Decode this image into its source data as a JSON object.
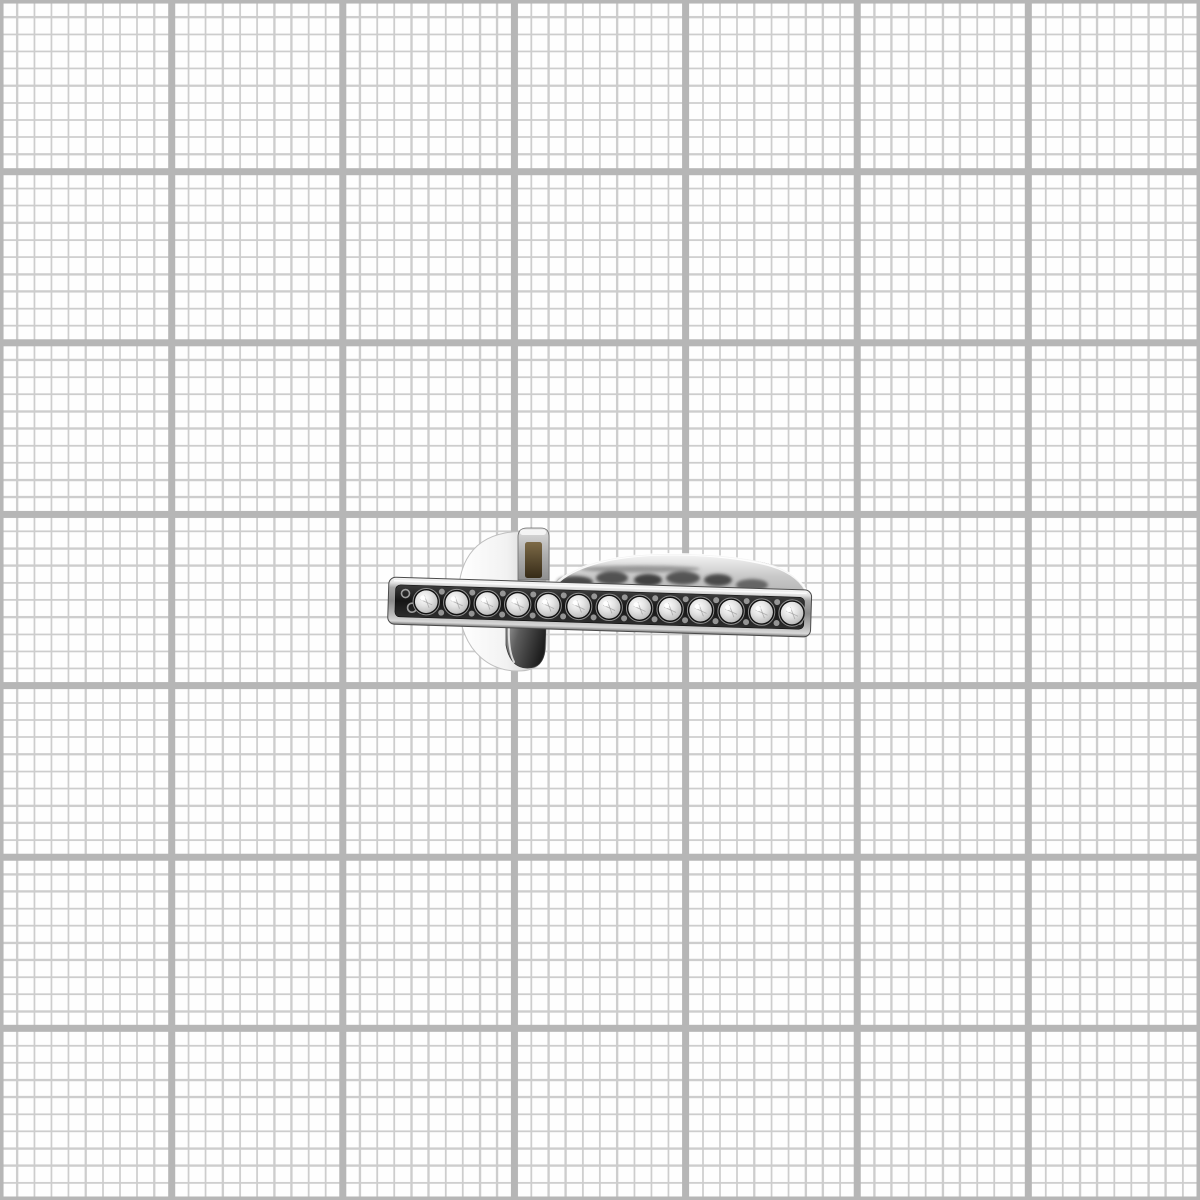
{
  "scene": {
    "subject": "antique silver-tone ring, side view, flat top bar channel-set with round clear crystals",
    "background": "white graph paper grid",
    "shadow": "none"
  },
  "grid": {
    "minor_step_px": 17.1429,
    "major_step_px": 171.4286,
    "minor_cells_per_major": 10,
    "major_columns": 7,
    "major_rows": 7,
    "minor_line_px": 2,
    "major_line_px": 7,
    "minor_color": "#cdcdcd",
    "major_color": "#b6b6b6",
    "paper_color": "#fefefe"
  },
  "ring": {
    "bar": {
      "left": 389,
      "top": 577,
      "width": 423,
      "height": 47,
      "tilt_deg": 1.78,
      "crystal_count": 13,
      "first_crystal_x": 427,
      "crystal_step_px": 30.5,
      "crystal_center_y": 600.5,
      "crystal_radius_px": 11.3,
      "bezel_radius_px": 13.2
    },
    "colors": {
      "metal_bright": "#ffffff",
      "metal_light": "#e8e8e8",
      "metal_mid": "#b0b0b0",
      "metal_dark": "#6f6f6f",
      "channel_dark": "#151515",
      "bezel_dark": "#101010",
      "crystal_center": "#ffffff",
      "crystal_mid": "#e3e3e3",
      "crystal_edge": "#a8a8a8",
      "slot_brown_light": "#7d6a47",
      "slot_brown_dark": "#362b18",
      "outline": "#4a4a4a"
    }
  }
}
